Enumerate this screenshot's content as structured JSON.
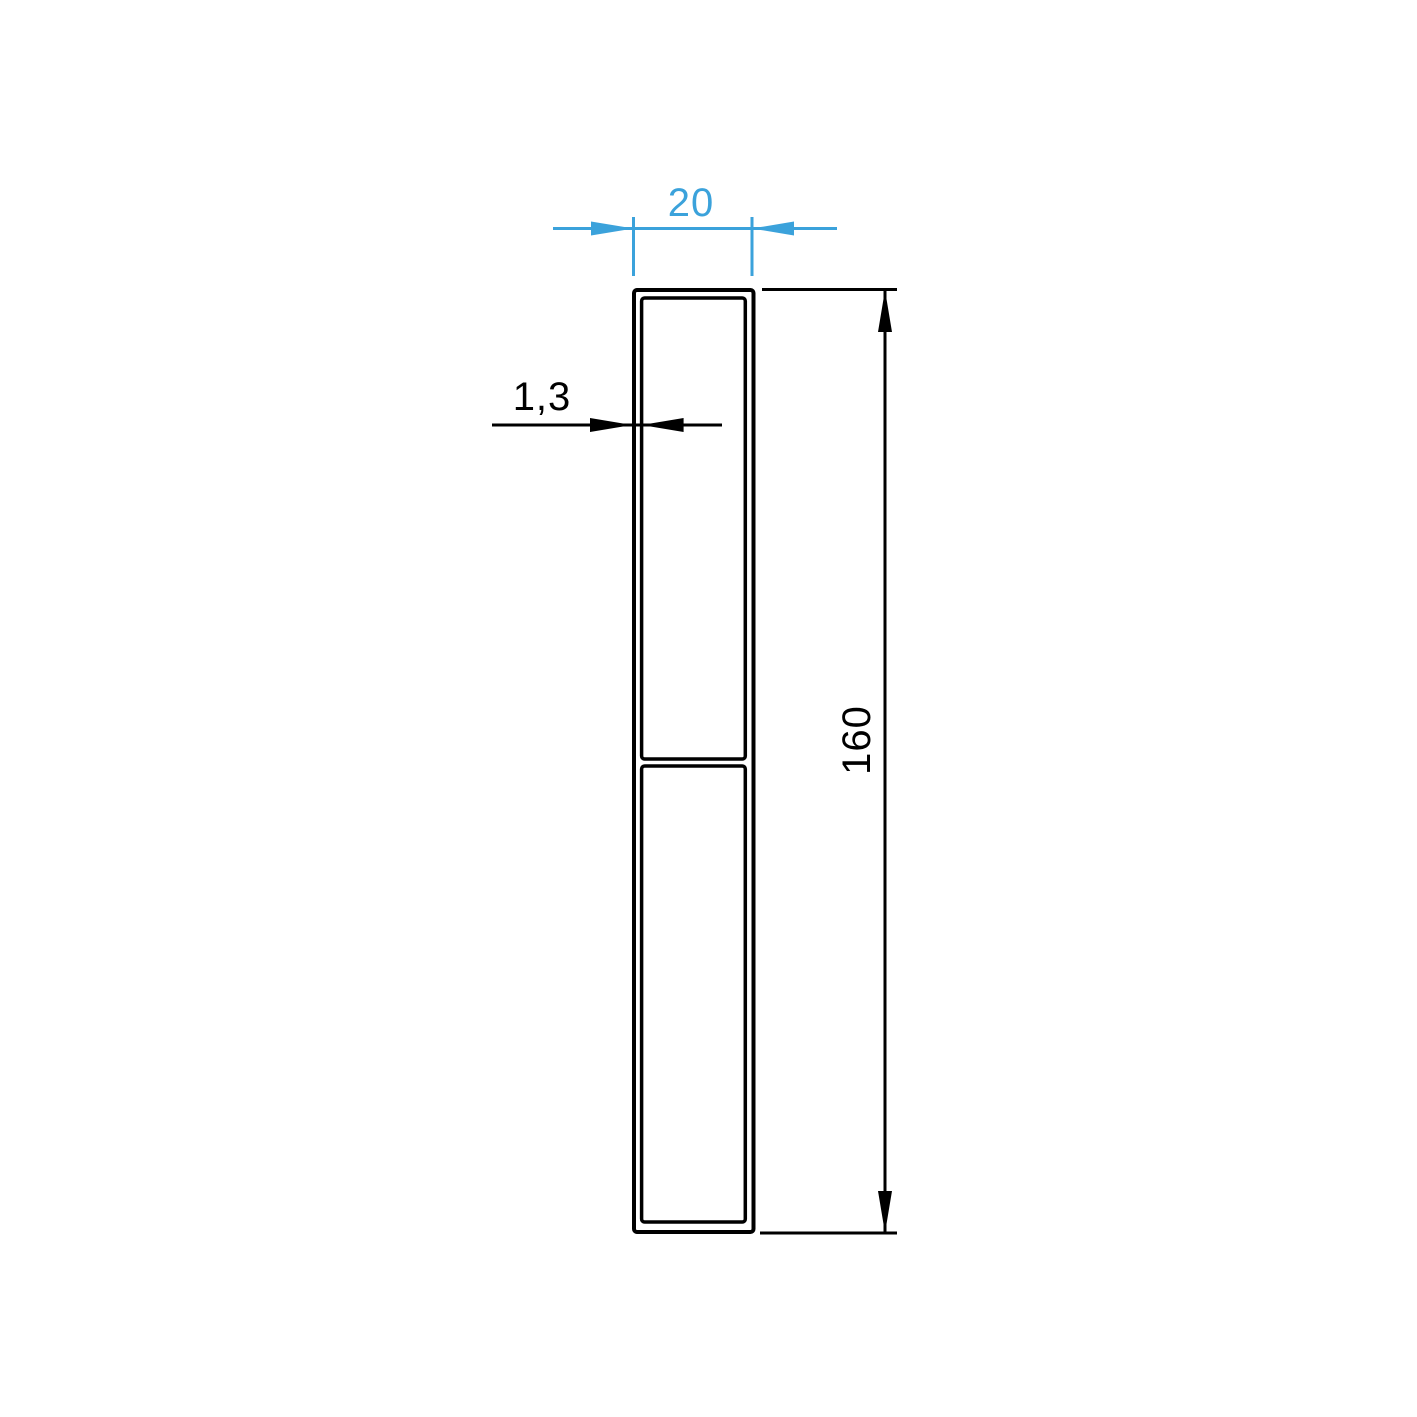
{
  "colors": {
    "accent": "#3ba2db",
    "line": "#000000",
    "background": "#ffffff"
  },
  "drawing": {
    "kind": "profile-cross-section",
    "dimensions": {
      "width": {
        "label": "20"
      },
      "wall_thickness": {
        "label": "1,3"
      },
      "height": {
        "label": "160"
      }
    }
  }
}
